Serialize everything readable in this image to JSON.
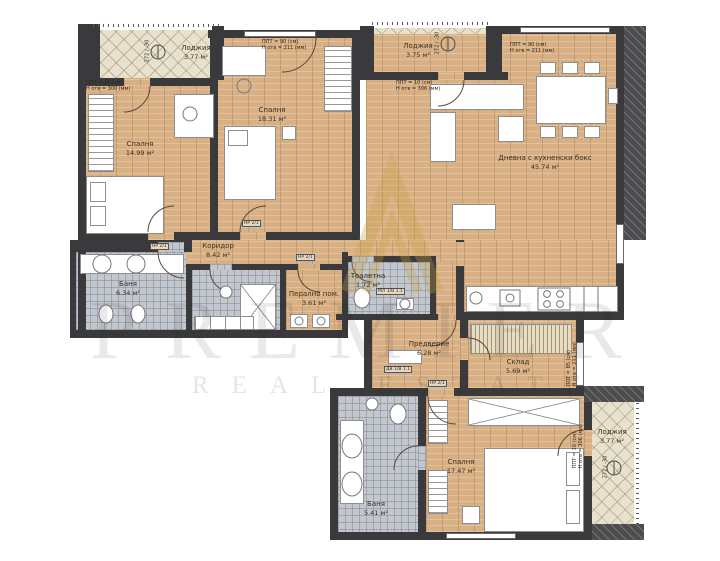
{
  "document": {
    "type": "apartment floor plan",
    "language": "bg"
  },
  "watermark": {
    "line1": "PREMIER",
    "line2": "REAL ESTATE"
  },
  "rooms": [
    {
      "name": "Спалня",
      "area": "14.99 м²"
    },
    {
      "name": "Спалня",
      "area": "18.31 м²"
    },
    {
      "name": "Дневна с кухненски бокс",
      "area": "45.74 м²"
    },
    {
      "name": "Лоджия",
      "area": "3.77 м²"
    },
    {
      "name": "Лоджия",
      "area": "3.75 м²"
    },
    {
      "name": "Баня",
      "area": "6.34 м²"
    },
    {
      "name": "Коридор",
      "area": "8.42 м²"
    },
    {
      "name": "Перално пом.",
      "area": "3.61 м²"
    },
    {
      "name": "Тоалетна",
      "area": "1.72 м²"
    },
    {
      "name": "Предверие",
      "area": "6.28 м²"
    },
    {
      "name": "Склад",
      "area": "5.69 м²"
    },
    {
      "name": "Спалня",
      "area": "17.47 м²"
    },
    {
      "name": "Баня",
      "area": "5.41 м²"
    },
    {
      "name": "Лоджия",
      "area": "3.77 м²"
    }
  ],
  "openings": [
    {
      "line1": "ППТ = 10 (см)",
      "line2": "Н отв = 300 (мм)"
    },
    {
      "line1": "ППТ = 90 (см)",
      "line2": "Н отв = 211 (мм)"
    },
    {
      "line1": "ППТ = 10 (см)",
      "line2": "Н отв = 306 (мм)"
    },
    {
      "line1": "ППТ = 90 (см)",
      "line2": "Н отв = 211 (мм)"
    },
    {
      "line1": "ППТ = 85 (см)",
      "line2": "Н отв = 211 (мм)"
    },
    {
      "line1": "ППТ = 10 (см)",
      "line2": "Н отв = 306 (мм)"
    }
  ],
  "door_tags": [
    "НР 2/1",
    "НР 2/1",
    "НР 2/1",
    "ДВ 1/В 1.1",
    "НР 2/1",
    "МЛ 1/В 1.1"
  ],
  "level_marks": [
    "272 / -30",
    "272 / -30",
    "272 / -30"
  ],
  "colors": {
    "wall": "#3a3a3c",
    "wood_floor": "#d7b086",
    "tile_floor": "#c3c7ce",
    "balcony_floor": "#e8e1cd",
    "furniture": "#ffffff",
    "watermark_gray": "#c9c9c9",
    "brand_gold": "#c6a244"
  }
}
